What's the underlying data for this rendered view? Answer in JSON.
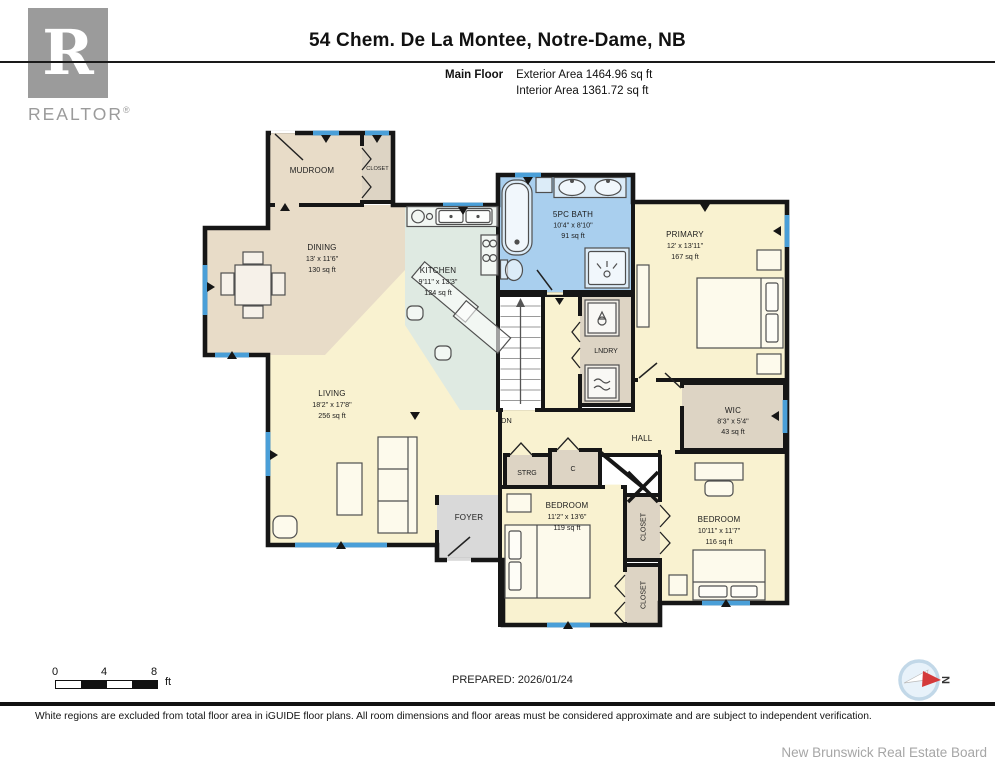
{
  "header": {
    "title": "54 Chem. De La Montee, Notre-Dame, NB",
    "floor_label": "Main Floor",
    "exterior_area": "Exterior Area 1464.96 sq ft",
    "interior_area": "Interior Area 1361.72 sq ft"
  },
  "logo": {
    "letter": "R",
    "brand": "REALTOR",
    "registered": "®"
  },
  "rooms": {
    "mudroom": {
      "name": "MUDROOM"
    },
    "closet_top": {
      "name": "CLOSET"
    },
    "dining": {
      "name": "DINING",
      "dims": "13' x 11'6\"",
      "area": "130 sq ft"
    },
    "kitchen": {
      "name": "KITCHEN",
      "dims": "9'11\" x 13'3\"",
      "area": "124 sq ft"
    },
    "bath": {
      "name": "5PC BATH",
      "dims": "10'4\" x 8'10\"",
      "area": "91 sq ft"
    },
    "primary": {
      "name": "PRIMARY",
      "dims": "12' x 13'11\"",
      "area": "167 sq ft"
    },
    "laundry": {
      "name": "LNDRY"
    },
    "stairs": {
      "label": "DN"
    },
    "living": {
      "name": "LIVING",
      "dims": "18'2\" x 17'8\"",
      "area": "256 sq ft"
    },
    "hall": {
      "name": "HALL"
    },
    "wic": {
      "name": "WIC",
      "dims": "8'3\" x 5'4\"",
      "area": "43 sq ft"
    },
    "strg": {
      "name": "STRG"
    },
    "closet_c": {
      "name": "C"
    },
    "bedroom1": {
      "name": "BEDROOM",
      "dims": "11'2\" x 13'6\"",
      "area": "119 sq ft"
    },
    "closet1": {
      "name": "CLOSET"
    },
    "closet2": {
      "name": "CLOSET"
    },
    "bedroom2": {
      "name": "BEDROOM",
      "dims": "10'11\" x 11'7\"",
      "area": "116 sq ft"
    },
    "foyer": {
      "name": "FOYER"
    }
  },
  "footer": {
    "scale": {
      "t0": "0",
      "t4": "4",
      "t8": "8",
      "unit": "ft"
    },
    "prepared": "PREPARED: 2026/01/24",
    "compass_north": "N",
    "disclaimer": "White regions are excluded from total floor area in iGUIDE floor plans. All room dimensions and floor areas must be considered approximate and are subject to independent verification.",
    "board": "New Brunswick Real Estate Board"
  },
  "colors": {
    "wall": "#161616",
    "window": "#4a9fd8",
    "room_cream": "#f9f2d0",
    "room_tan": "#e8dcc8",
    "room_closet": "#ddd4c4",
    "room_kitchen": "#dfeae2",
    "room_bath": "#a9cfee",
    "room_foyer": "#d9d9d9",
    "logo_gray": "#9b9b9b",
    "compass_red": "#d43a3a"
  }
}
